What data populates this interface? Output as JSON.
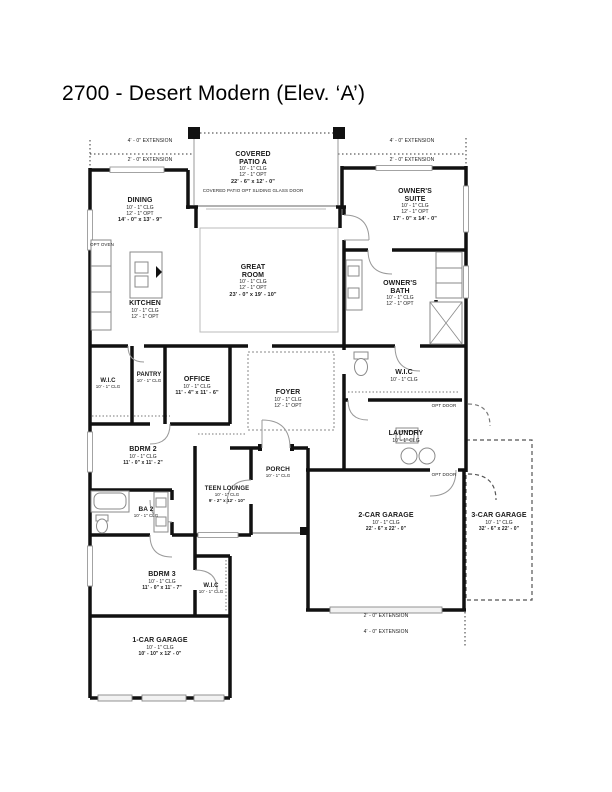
{
  "title": "2700 - Desert Modern (Elev. ‘A’)",
  "rooms": {
    "covered_patio": {
      "name": "COVERED PATIO A",
      "clg": "10' - 1\" CLG",
      "opt": "12' - 1\" OPT",
      "dims": "22' - 6\" x 12' - 0\""
    },
    "dining": {
      "name": "DINING",
      "clg": "10' - 1\" CLG",
      "opt": "12' - 1\" OPT",
      "dims": "14' - 0\" x 13' - 9\""
    },
    "owners_suite": {
      "name": "OWNER'S SUITE",
      "clg": "10' - 1\" CLG",
      "opt": "12' - 1\" OPT",
      "dims": "17' - 0\" x 14' - 0\""
    },
    "great_room": {
      "name": "GREAT ROOM",
      "clg": "10' - 1\" CLG",
      "opt": "12' - 1\" OPT",
      "dims": "23' - 0\" x 19' - 10\""
    },
    "kitchen": {
      "name": "KITCHEN",
      "clg": "10' - 1\" CLG",
      "opt": "12' - 1\" OPT"
    },
    "owners_bath": {
      "name": "OWNER'S BATH",
      "clg": "10' - 1\" CLG",
      "opt": "12' - 1\" OPT"
    },
    "wic_owners": {
      "name": "W.I.C",
      "clg": "10' - 1\" CLG"
    },
    "laundry": {
      "name": "LAUNDRY",
      "clg": "10' - 1\" CLG"
    },
    "foyer": {
      "name": "FOYER",
      "clg": "10' - 1\" CLG",
      "opt": "12' - 1\" OPT"
    },
    "office": {
      "name": "OFFICE",
      "clg": "10' - 1\" CLG",
      "dims": "11' - 4\" x 11' - 6\""
    },
    "pantry": {
      "name": "PANTRY",
      "clg": "10' - 1\" CLG"
    },
    "wic_hall": {
      "name": "W.I.C",
      "clg": "10' - 1\" CLG"
    },
    "bdrm2": {
      "name": "BDRM 2",
      "clg": "10' - 1\" CLG",
      "dims": "11' - 0\" x 11' - 2\""
    },
    "teen_lounge": {
      "name": "TEEN LOUNGE",
      "clg": "10' - 1\" CLG",
      "dims": "9' - 2\" x 12' - 10\""
    },
    "porch": {
      "name": "PORCH",
      "clg": "10' - 1\" CLG"
    },
    "ba2": {
      "name": "BA 2",
      "clg": "10' - 1\" CLG"
    },
    "bdrm3": {
      "name": "BDRM 3",
      "clg": "10' - 1\" CLG",
      "dims": "11' - 0\" x 11' - 7\""
    },
    "wic_bdrm3": {
      "name": "W.I.C",
      "clg": "10' - 1\" CLG"
    },
    "garage2": {
      "name": "2-CAR GARAGE",
      "clg": "10' - 1\" CLG",
      "dims": "22' - 6\" x 22' - 0\""
    },
    "garage3": {
      "name": "3-CAR GARAGE",
      "clg": "10' - 1\" CLG",
      "dims": "32' - 6\" x 22' - 0\""
    },
    "garage1": {
      "name": "1-CAR GARAGE",
      "clg": "10' - 1\" CLG",
      "dims": "10' - 10\" x 12' - 0\""
    }
  },
  "annotations": {
    "patio_note": "COVERED PATIO OPT SLIDING GLASS DOOR",
    "opt_oven": "OPT OVEN",
    "opt_door": "OPT DOOR",
    "ext_4": "4' - 0\" EXTENSION",
    "ext_2": "2' - 0\" EXTENSION"
  },
  "colors": {
    "wall": "#111111",
    "thin_line": "#999999",
    "dashed_line": "#555555",
    "text": "#1a1a1a",
    "background": "#ffffff"
  }
}
